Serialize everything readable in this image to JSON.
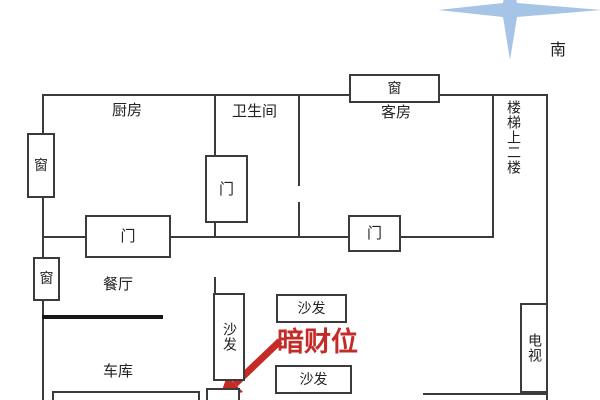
{
  "compass": {
    "south": "南"
  },
  "rooms": {
    "kitchen": "厨房",
    "bathroom": "卫生间",
    "guest_room": "客房",
    "stairs": "楼梯上二楼",
    "dining_room": "餐厅",
    "garage": "车库"
  },
  "fixtures": {
    "window": "窗",
    "door": "门",
    "sofa": "沙发",
    "tv": "电视"
  },
  "annotation": {
    "wealth_spot": "暗财位"
  },
  "colors": {
    "wall": "#3b3b3b",
    "annotation_red": "#c42a26",
    "compass_blue": "#a6c4e6"
  }
}
